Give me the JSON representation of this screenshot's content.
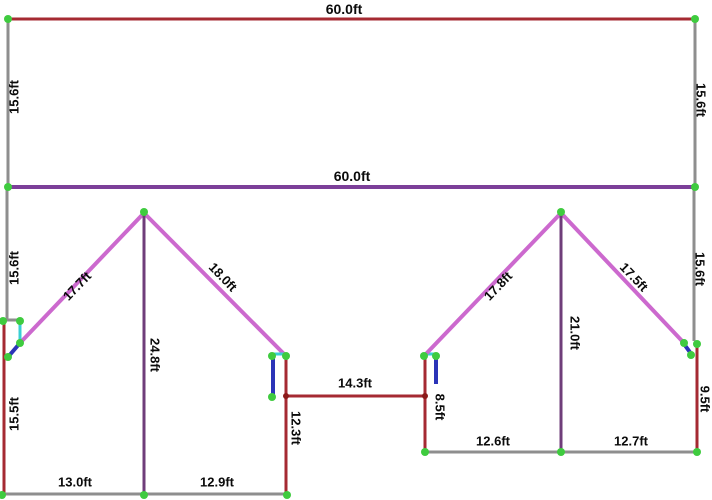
{
  "diagram": {
    "width": 712,
    "height": 500,
    "background": "#ffffff",
    "colors": {
      "red": "#a52a32",
      "gray": "#8e8e8e",
      "purple": "#7c3f99",
      "dark_purple": "#6f3d7a",
      "magenta": "#cc69ce",
      "cyan": "#39cfd4",
      "blue": "#2b34b8",
      "green_dot": "#3fcb3f",
      "dark_red_dot": "#8b1a1a",
      "text": "#0b0b0b"
    },
    "lines": [
      {
        "name": "top-width-line",
        "color": "red",
        "x1": 8,
        "y1": 19,
        "x2": 695,
        "y2": 19,
        "w": 3
      },
      {
        "name": "left-wall-upper-line",
        "color": "gray",
        "x1": 8,
        "y1": 19,
        "x2": 8,
        "y2": 187,
        "w": 3
      },
      {
        "name": "right-wall-upper-line",
        "color": "gray",
        "x1": 695,
        "y1": 19,
        "x2": 695,
        "y2": 187,
        "w": 3
      },
      {
        "name": "mid-width-line",
        "color": "purple",
        "x1": 8,
        "y1": 187,
        "x2": 695,
        "y2": 187,
        "w": 4
      },
      {
        "name": "left-wall-lower-line",
        "color": "gray",
        "x1": 7,
        "y1": 187,
        "x2": 7,
        "y2": 320,
        "w": 3
      },
      {
        "name": "left-eave-jog-line",
        "color": "gray",
        "x1": 5,
        "y1": 320,
        "x2": 20,
        "y2": 320,
        "w": 3
      },
      {
        "name": "left-eave-riser-line",
        "color": "cyan",
        "x1": 20,
        "y1": 321,
        "x2": 20,
        "y2": 344,
        "w": 3
      },
      {
        "name": "left-eave-brace-line",
        "color": "blue",
        "x1": 20,
        "y1": 343,
        "x2": 8,
        "y2": 357,
        "w": 4
      },
      {
        "name": "left-house-left-wall-line",
        "color": "red",
        "x1": 4,
        "y1": 322,
        "x2": 4,
        "y2": 494,
        "w": 3
      },
      {
        "name": "left-roof-west-line",
        "color": "magenta",
        "x1": 20,
        "y1": 343,
        "x2": 144,
        "y2": 213,
        "w": 4
      },
      {
        "name": "left-roof-east-line",
        "color": "magenta",
        "x1": 144,
        "y1": 213,
        "x2": 286,
        "y2": 356,
        "w": 4
      },
      {
        "name": "left-ridge-height-line",
        "color": "dark_purple",
        "x1": 144,
        "y1": 213,
        "x2": 144,
        "y2": 494,
        "w": 3
      },
      {
        "name": "left-eave-top-line",
        "color": "cyan",
        "x1": 272,
        "y1": 354,
        "x2": 285,
        "y2": 354,
        "w": 3
      },
      {
        "name": "left-eave-drop-line",
        "color": "blue",
        "x1": 273,
        "y1": 357,
        "x2": 273,
        "y2": 396,
        "w": 4
      },
      {
        "name": "left-house-right-wall-line",
        "color": "red",
        "x1": 286,
        "y1": 356,
        "x2": 286,
        "y2": 495,
        "w": 3
      },
      {
        "name": "breezeway-width-line",
        "color": "red",
        "x1": 286,
        "y1": 396,
        "x2": 425,
        "y2": 396,
        "w": 3
      },
      {
        "name": "left-house-bottom-line",
        "color": "gray",
        "x1": 2,
        "y1": 494,
        "x2": 288,
        "y2": 494,
        "w": 3
      },
      {
        "name": "right-eave-top-line",
        "color": "cyan",
        "x1": 424,
        "y1": 354,
        "x2": 436,
        "y2": 354,
        "w": 3
      },
      {
        "name": "right-house-left-wall-line",
        "color": "red",
        "x1": 425,
        "y1": 357,
        "x2": 425,
        "y2": 452,
        "w": 3
      },
      {
        "name": "right-eave-drop-line",
        "color": "blue",
        "x1": 436,
        "y1": 357,
        "x2": 436,
        "y2": 384,
        "w": 4
      },
      {
        "name": "right-roof-west-line",
        "color": "magenta",
        "x1": 424,
        "y1": 356,
        "x2": 561,
        "y2": 213,
        "w": 4
      },
      {
        "name": "right-roof-east-line",
        "color": "magenta",
        "x1": 561,
        "y1": 213,
        "x2": 684,
        "y2": 343,
        "w": 4
      },
      {
        "name": "right-ridge-height-line",
        "color": "dark_purple",
        "x1": 561,
        "y1": 213,
        "x2": 561,
        "y2": 452,
        "w": 3
      },
      {
        "name": "right-wall-lower-line",
        "color": "gray",
        "x1": 694,
        "y1": 187,
        "x2": 694,
        "y2": 341,
        "w": 3
      },
      {
        "name": "right-eave-brace-line",
        "color": "blue",
        "x1": 684,
        "y1": 344,
        "x2": 692,
        "y2": 355,
        "w": 4
      },
      {
        "name": "right-house-right-wall-line",
        "color": "red",
        "x1": 697,
        "y1": 344,
        "x2": 697,
        "y2": 452,
        "w": 3
      },
      {
        "name": "right-house-bottom-line",
        "color": "gray",
        "x1": 424,
        "y1": 452,
        "x2": 697,
        "y2": 452,
        "w": 3
      }
    ],
    "dots": [
      {
        "x": 8,
        "y": 19,
        "r": 4,
        "color": "green_dot"
      },
      {
        "x": 695,
        "y": 19,
        "r": 4,
        "color": "green_dot"
      },
      {
        "x": 8,
        "y": 187,
        "r": 4,
        "color": "green_dot"
      },
      {
        "x": 695,
        "y": 187,
        "r": 4,
        "color": "green_dot"
      },
      {
        "x": 3,
        "y": 321,
        "r": 4,
        "color": "green_dot"
      },
      {
        "x": 20,
        "y": 321,
        "r": 4,
        "color": "green_dot"
      },
      {
        "x": 20,
        "y": 343,
        "r": 4,
        "color": "green_dot"
      },
      {
        "x": 8,
        "y": 357,
        "r": 4,
        "color": "green_dot"
      },
      {
        "x": 144,
        "y": 212,
        "r": 4,
        "color": "green_dot"
      },
      {
        "x": 2,
        "y": 495,
        "r": 4,
        "color": "green_dot"
      },
      {
        "x": 144,
        "y": 495,
        "r": 4,
        "color": "green_dot"
      },
      {
        "x": 287,
        "y": 495,
        "r": 4,
        "color": "green_dot"
      },
      {
        "x": 272,
        "y": 356,
        "r": 4,
        "color": "green_dot"
      },
      {
        "x": 286,
        "y": 356,
        "r": 4,
        "color": "green_dot"
      },
      {
        "x": 272,
        "y": 397,
        "r": 4,
        "color": "green_dot"
      },
      {
        "x": 424,
        "y": 356,
        "r": 4,
        "color": "green_dot"
      },
      {
        "x": 436,
        "y": 356,
        "r": 4,
        "color": "green_dot"
      },
      {
        "x": 425,
        "y": 452,
        "r": 4,
        "color": "green_dot"
      },
      {
        "x": 561,
        "y": 452,
        "r": 4,
        "color": "green_dot"
      },
      {
        "x": 697,
        "y": 452,
        "r": 4,
        "color": "green_dot"
      },
      {
        "x": 561,
        "y": 212,
        "r": 4,
        "color": "green_dot"
      },
      {
        "x": 684,
        "y": 343,
        "r": 4,
        "color": "green_dot"
      },
      {
        "x": 697,
        "y": 344,
        "r": 4,
        "color": "green_dot"
      },
      {
        "x": 691,
        "y": 355,
        "r": 4,
        "color": "green_dot"
      },
      {
        "x": 286,
        "y": 396,
        "r": 3,
        "color": "dark_red_dot"
      },
      {
        "x": 425,
        "y": 396,
        "r": 3,
        "color": "dark_red_dot"
      }
    ],
    "labels": [
      {
        "name": "label-top-width",
        "text": "60.0ft",
        "x": 344,
        "y": 9,
        "rotate": 0,
        "size": 14
      },
      {
        "name": "label-left-wall-upper",
        "text": "15.6ft",
        "x": 14,
        "y": 97,
        "rotate": -90,
        "size": 13
      },
      {
        "name": "label-right-wall-upper",
        "text": "15.6ft",
        "x": 701,
        "y": 100,
        "rotate": 90,
        "size": 13
      },
      {
        "name": "label-mid-width",
        "text": "60.0ft",
        "x": 352,
        "y": 176,
        "rotate": 0,
        "size": 14
      },
      {
        "name": "label-left-wall-lower",
        "text": "15.6ft",
        "x": 14,
        "y": 268,
        "rotate": -90,
        "size": 13
      },
      {
        "name": "label-right-wall-lower",
        "text": "15.6ft",
        "x": 700,
        "y": 269,
        "rotate": 90,
        "size": 13
      },
      {
        "name": "label-left-roof-west",
        "text": "17.7ft",
        "x": 77,
        "y": 286,
        "rotate": -46,
        "size": 13
      },
      {
        "name": "label-left-roof-east",
        "text": "18.0ft",
        "x": 223,
        "y": 277,
        "rotate": 46,
        "size": 13
      },
      {
        "name": "label-right-roof-west",
        "text": "17.8ft",
        "x": 498,
        "y": 286,
        "rotate": -46,
        "size": 13
      },
      {
        "name": "label-right-roof-east",
        "text": "17.5ft",
        "x": 634,
        "y": 277,
        "rotate": 46,
        "size": 13
      },
      {
        "name": "label-left-ridge-height",
        "text": "24.8ft",
        "x": 155,
        "y": 355,
        "rotate": 90,
        "size": 13
      },
      {
        "name": "label-right-ridge-height",
        "text": "21.0ft",
        "x": 575,
        "y": 333,
        "rotate": 90,
        "size": 13
      },
      {
        "name": "label-left-house-left-wall",
        "text": "15.5ft",
        "x": 14,
        "y": 414,
        "rotate": -90,
        "size": 13
      },
      {
        "name": "label-left-house-right-wall",
        "text": "12.3ft",
        "x": 296,
        "y": 428,
        "rotate": 90,
        "size": 13
      },
      {
        "name": "label-right-house-left-wall",
        "text": "8.5ft",
        "x": 440,
        "y": 407,
        "rotate": 90,
        "size": 13
      },
      {
        "name": "label-right-house-right-wall",
        "text": "9.5ft",
        "x": 705,
        "y": 399,
        "rotate": 90,
        "size": 13
      },
      {
        "name": "label-breezeway-width",
        "text": "14.3ft",
        "x": 355,
        "y": 383,
        "rotate": 0,
        "size": 13
      },
      {
        "name": "label-left-bottom-west",
        "text": "13.0ft",
        "x": 75,
        "y": 482,
        "rotate": 0,
        "size": 13
      },
      {
        "name": "label-left-bottom-east",
        "text": "12.9ft",
        "x": 217,
        "y": 482,
        "rotate": 0,
        "size": 13
      },
      {
        "name": "label-right-bottom-west",
        "text": "12.6ft",
        "x": 493,
        "y": 441,
        "rotate": 0,
        "size": 13
      },
      {
        "name": "label-right-bottom-east",
        "text": "12.7ft",
        "x": 631,
        "y": 441,
        "rotate": 0,
        "size": 13
      }
    ]
  }
}
